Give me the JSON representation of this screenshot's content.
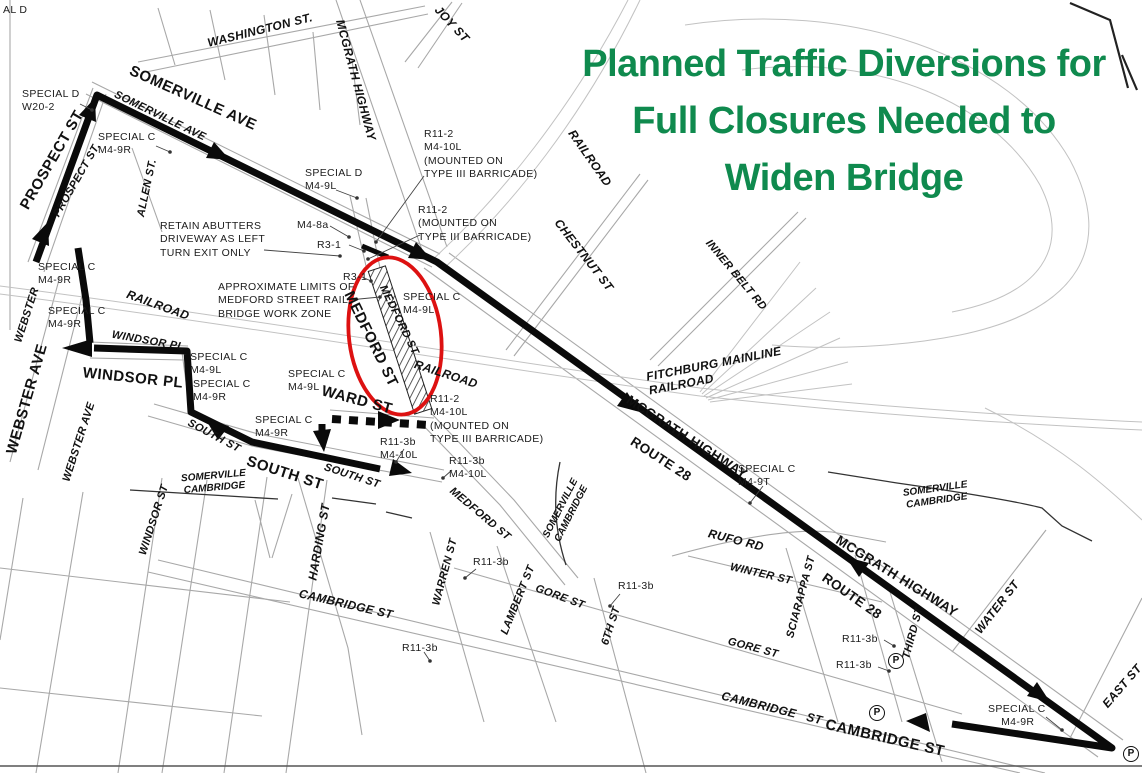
{
  "title": {
    "text": "Planned Traffic Diversions for\nFull Closures Needed to\nWiden Bridge"
  },
  "colors": {
    "title_green": "#0f8a4e",
    "closure_red": "#dd1111",
    "route_black": "#0a0a0a",
    "map_gray": "#a8a8a8"
  },
  "labels": [
    {
      "t": "SOMERVILLE AVE",
      "x": 193,
      "y": 98,
      "r": 24,
      "s": "sb",
      "n": "street-label-somerville-ave"
    },
    {
      "t": "PROSPECT ST",
      "x": 52,
      "y": 160,
      "r": -60,
      "s": "sb",
      "n": "street-label-prospect-st"
    },
    {
      "t": "WEBSTER AVE",
      "x": 27,
      "y": 399,
      "r": -74,
      "s": "sb",
      "n": "street-label-webster-ave"
    },
    {
      "t": "WINDSOR PL",
      "x": 133,
      "y": 378,
      "r": 6,
      "s": "sb",
      "n": "street-label-windsor-pl"
    },
    {
      "t": "SOUTH ST",
      "x": 285,
      "y": 473,
      "r": 18,
      "s": "sb",
      "n": "street-label-south-st"
    },
    {
      "t": "WARD ST",
      "x": 357,
      "y": 400,
      "r": 15,
      "s": "sb",
      "n": "street-label-ward-st"
    },
    {
      "t": "MEDFORD ST",
      "x": 371,
      "y": 339,
      "r": 64,
      "s": "sb",
      "n": "street-label-medford-st"
    },
    {
      "t": "MCGRATH HIGHWAY",
      "x": 687,
      "y": 437,
      "r": 33,
      "s": "sbm",
      "n": "street-label-mcgrath-highway"
    },
    {
      "t": "ROUTE 28",
      "x": 661,
      "y": 459,
      "r": 33,
      "s": "sbm",
      "n": "street-label-route-28"
    },
    {
      "t": "MCGRATH HIGHWAY",
      "x": 897,
      "y": 576,
      "r": 32,
      "s": "sbm",
      "n": "street-label-mcgrath-highway"
    },
    {
      "t": "ROUTE 28",
      "x": 852,
      "y": 596,
      "r": 35,
      "s": "sbm",
      "n": "street-label-route-28"
    },
    {
      "t": "CAMBRIDGE ST",
      "x": 885,
      "y": 738,
      "r": 13,
      "s": "sb",
      "n": "street-label-cambridge-st"
    },
    {
      "t": "SOMERVILLE AVE",
      "x": 160,
      "y": 116,
      "r": 26,
      "s": "si",
      "n": "street-label-somerville-ave-italic"
    },
    {
      "t": "PROSPECT ST.",
      "x": 77,
      "y": 180,
      "r": -60,
      "s": "si",
      "n": "street-label-prospect-st-italic"
    },
    {
      "t": "WASHINGTON ST.",
      "x": 260,
      "y": 30,
      "r": -14,
      "s": "si2",
      "n": "street-label-washington-st"
    },
    {
      "t": "MCGRATH HIGHWAY",
      "x": 356,
      "y": 80,
      "r": 75,
      "s": "si2",
      "n": "street-label-mcgrath-highway-italic"
    },
    {
      "t": "JOY ST",
      "x": 452,
      "y": 24,
      "r": 47,
      "s": "si2",
      "n": "street-label-joy-st"
    },
    {
      "t": "ALLEN ST.",
      "x": 147,
      "y": 188,
      "r": -78,
      "s": "si",
      "n": "street-label-allen-st"
    },
    {
      "t": "RAILROAD",
      "x": 590,
      "y": 158,
      "r": 55,
      "s": "si2",
      "n": "railroad-label"
    },
    {
      "t": "CHESTNUT ST",
      "x": 584,
      "y": 255,
      "r": 52,
      "s": "si2",
      "n": "street-label-chestnut-st"
    },
    {
      "t": "INNER BELT RD",
      "x": 736,
      "y": 275,
      "r": 50,
      "s": "si",
      "n": "street-label-inner-belt-rd"
    },
    {
      "t": "RAILROAD",
      "x": 158,
      "y": 305,
      "r": 20,
      "s": "si2",
      "n": "railroad-label"
    },
    {
      "t": "RAILROAD",
      "x": 446,
      "y": 374,
      "r": 18,
      "s": "si2",
      "n": "railroad-label"
    },
    {
      "t": "WEBSTER",
      "x": 27,
      "y": 315,
      "r": -72,
      "s": "si",
      "n": "street-label-webster"
    },
    {
      "t": "WEBSTER AVE",
      "x": 79,
      "y": 442,
      "r": -72,
      "s": "si",
      "n": "street-label-webster-ave-italic"
    },
    {
      "t": "WINDSOR PL",
      "x": 148,
      "y": 341,
      "r": 10,
      "s": "si",
      "n": "street-label-windsor-pl-italic"
    },
    {
      "t": "SOUTH ST",
      "x": 214,
      "y": 436,
      "r": 28,
      "s": "si",
      "n": "street-label-south-st-italic"
    },
    {
      "t": "SOUTH ST",
      "x": 352,
      "y": 476,
      "r": 18,
      "s": "si",
      "n": "street-label-south-st-italic"
    },
    {
      "t": "MEDFORD ST",
      "x": 399,
      "y": 320,
      "r": 64,
      "s": "si",
      "n": "street-label-medford-st-italic"
    },
    {
      "t": "MEDFORD ST",
      "x": 480,
      "y": 514,
      "r": 40,
      "s": "si",
      "n": "street-label-medford-st-italic"
    },
    {
      "t": "HARDING ST",
      "x": 319,
      "y": 542,
      "r": -80,
      "s": "si2",
      "n": "street-label-harding-st"
    },
    {
      "t": "WINDSOR ST",
      "x": 154,
      "y": 520,
      "r": -72,
      "s": "si",
      "n": "street-label-windsor-st"
    },
    {
      "t": "WARREN ST",
      "x": 445,
      "y": 572,
      "r": -75,
      "s": "si",
      "n": "street-label-warren-st"
    },
    {
      "t": "LAMBERT ST",
      "x": 518,
      "y": 600,
      "r": -68,
      "s": "si",
      "n": "street-label-lambert-st"
    },
    {
      "t": "GORE ST",
      "x": 560,
      "y": 597,
      "r": 20,
      "s": "si",
      "n": "street-label-gore-st"
    },
    {
      "t": "6TH ST",
      "x": 611,
      "y": 626,
      "r": -72,
      "s": "si",
      "n": "street-label-6th-st"
    },
    {
      "t": "SCIARAPPA ST",
      "x": 801,
      "y": 597,
      "r": -75,
      "s": "si",
      "n": "street-label-sciarappa-st"
    },
    {
      "t": "WINTER ST",
      "x": 761,
      "y": 574,
      "r": 13,
      "s": "si",
      "n": "street-label-winter-st"
    },
    {
      "t": "RUFO RD",
      "x": 736,
      "y": 540,
      "r": 14,
      "s": "si2",
      "n": "street-label-rufo-rd"
    },
    {
      "t": "GORE ST",
      "x": 753,
      "y": 648,
      "r": 15,
      "s": "si",
      "n": "street-label-gore-st"
    },
    {
      "t": "CAMBRIDGE ST",
      "x": 346,
      "y": 604,
      "r": 13,
      "s": "si2",
      "n": "street-label-cambridge-st-italic"
    },
    {
      "t": "CAMBRIDGE   ST",
      "x": 772,
      "y": 708,
      "r": 14,
      "s": "si2",
      "n": "street-label-cambridge-st-italic"
    },
    {
      "t": "THIRD ST",
      "x": 913,
      "y": 633,
      "r": -75,
      "s": "si",
      "n": "street-label-third-st"
    },
    {
      "t": "WATER ST",
      "x": 997,
      "y": 607,
      "r": -52,
      "s": "si2",
      "n": "street-label-water-st"
    },
    {
      "t": "EAST ST",
      "x": 1122,
      "y": 686,
      "r": -49,
      "s": "si2",
      "n": "street-label-east-st"
    },
    {
      "t": "FITCHBURG MAINLINE\nRAILROAD",
      "x": 645,
      "y": 370,
      "r": -11,
      "s": "si2",
      "a": "tl",
      "n": "railroad-label-fitchburg"
    },
    {
      "t": "SOMERVILLE\nCAMBRIDGE",
      "x": 214,
      "y": 482,
      "r": -5,
      "s": "bd",
      "n": "city-boundary-label"
    },
    {
      "t": "SOMERVILLE\nCAMBRIDGE",
      "x": 566,
      "y": 511,
      "r": -63,
      "s": "bd",
      "n": "city-boundary-label"
    },
    {
      "t": "SOMERVILLE\nCAMBRIDGE",
      "x": 936,
      "y": 495,
      "r": -8,
      "s": "bd",
      "n": "city-boundary-label"
    },
    {
      "t": "AL D",
      "x": 3,
      "y": 4,
      "r": 0,
      "s": "co",
      "a": "tl",
      "n": "sign-callout-partial"
    },
    {
      "t": "SPECIAL D\nW20-2",
      "x": 22,
      "y": 88,
      "s": "co",
      "a": "tl",
      "n": "sign-callout-special-d-w20-2"
    },
    {
      "t": "SPECIAL C\nM4-9R",
      "x": 98,
      "y": 131,
      "s": "co",
      "a": "tl",
      "n": "sign-callout-special-c-m4-9r"
    },
    {
      "t": "SPECIAL D\nM4-9L",
      "x": 305,
      "y": 167,
      "s": "co",
      "a": "tl",
      "n": "sign-callout-special-d-m4-9l"
    },
    {
      "t": "M4-8a",
      "x": 297,
      "y": 219,
      "s": "co",
      "a": "tl",
      "n": "sign-callout-m4-8a"
    },
    {
      "t": "R3-1",
      "x": 317,
      "y": 239,
      "s": "co",
      "a": "tl",
      "n": "sign-callout-r3-1"
    },
    {
      "t": "R11-2\nM4-10L\n(MOUNTED ON\nTYPE III BARRICADE)",
      "x": 424,
      "y": 128,
      "s": "co",
      "a": "tl",
      "n": "sign-callout-r11-2-m4-10l"
    },
    {
      "t": "R11-2\n(MOUNTED ON\nTYPE III BARRICADE)",
      "x": 418,
      "y": 204,
      "s": "co",
      "a": "tl",
      "n": "sign-callout-r11-2"
    },
    {
      "t": "RETAIN ABUTTERS\nDRIVEWAY AS LEFT\nTURN EXIT ONLY",
      "x": 160,
      "y": 220,
      "s": "co",
      "a": "tl",
      "n": "note-retain-abutters"
    },
    {
      "t": "R3-1",
      "x": 343,
      "y": 271,
      "s": "co",
      "a": "tl",
      "n": "sign-callout-r3-1"
    },
    {
      "t": "APPROXIMATE LIMITS OF\nMEDFORD STREET RAIL\nBRIDGE WORK ZONE",
      "x": 218,
      "y": 281,
      "s": "co",
      "a": "tl",
      "n": "note-work-zone-limits"
    },
    {
      "t": "SPECIAL C\nM4-9L",
      "x": 403,
      "y": 291,
      "s": "co",
      "a": "tl",
      "n": "sign-callout-special-c-m4-9l"
    },
    {
      "t": "SPECIAL C\nM4-9R",
      "x": 38,
      "y": 261,
      "s": "co",
      "a": "tl",
      "n": "sign-callout-special-c-m4-9r"
    },
    {
      "t": "SPECIAL C\nM4-9R",
      "x": 48,
      "y": 305,
      "s": "co",
      "a": "tl",
      "n": "sign-callout-special-c-m4-9r"
    },
    {
      "t": "SPECIAL C\nM4-9L",
      "x": 190,
      "y": 351,
      "s": "co",
      "a": "tl",
      "n": "sign-callout-special-c-m4-9l"
    },
    {
      "t": "SPECIAL C\nM4-9R",
      "x": 193,
      "y": 378,
      "s": "co",
      "a": "tl",
      "n": "sign-callout-special-c-m4-9r"
    },
    {
      "t": "SPECIAL C\nM4-9L",
      "x": 288,
      "y": 368,
      "s": "co",
      "a": "tl",
      "n": "sign-callout-special-c-m4-9l"
    },
    {
      "t": "SPECIAL C\nM4-9R",
      "x": 255,
      "y": 414,
      "s": "co",
      "a": "tl",
      "n": "sign-callout-special-c-m4-9r"
    },
    {
      "t": "R11-2\nM4-10L\n(MOUNTED ON\nTYPE III BARRICADE)",
      "x": 430,
      "y": 393,
      "s": "co",
      "a": "tl",
      "n": "sign-callout-r11-2-m4-10l"
    },
    {
      "t": "R11-3b\nM4-10L",
      "x": 380,
      "y": 436,
      "s": "co",
      "a": "tl",
      "n": "sign-callout-r11-3b-m4-10l"
    },
    {
      "t": "R11-3b\nM4-10L",
      "x": 449,
      "y": 455,
      "s": "co",
      "a": "tl",
      "n": "sign-callout-r11-3b-m4-10l"
    },
    {
      "t": "R11-3b",
      "x": 473,
      "y": 556,
      "s": "co",
      "a": "tl",
      "n": "sign-callout-r11-3b"
    },
    {
      "t": "R11-3b",
      "x": 618,
      "y": 580,
      "s": "co",
      "a": "tl",
      "n": "sign-callout-r11-3b"
    },
    {
      "t": "R11-3b",
      "x": 402,
      "y": 642,
      "s": "co",
      "a": "tl",
      "n": "sign-callout-r11-3b"
    },
    {
      "t": "SPECIAL C\nM4-9T",
      "x": 738,
      "y": 463,
      "s": "co",
      "a": "tl",
      "n": "sign-callout-special-c-m4-9t"
    },
    {
      "t": "R11-3b",
      "x": 842,
      "y": 633,
      "s": "co",
      "a": "tl",
      "n": "sign-callout-r11-3b"
    },
    {
      "t": "R11-3b",
      "x": 836,
      "y": 659,
      "s": "co",
      "a": "tl",
      "n": "sign-callout-r11-3b"
    },
    {
      "t": "SPECIAL C\n    M4-9R",
      "x": 988,
      "y": 703,
      "s": "co",
      "a": "tl",
      "n": "sign-callout-special-c-m4-9r"
    },
    {
      "t": "P",
      "x": 896,
      "y": 661,
      "s": "pc",
      "n": "parking-symbol"
    },
    {
      "t": "P",
      "x": 877,
      "y": 713,
      "s": "pc",
      "n": "parking-symbol"
    },
    {
      "t": "P",
      "x": 1131,
      "y": 754,
      "s": "pc",
      "n": "parking-symbol"
    }
  ]
}
